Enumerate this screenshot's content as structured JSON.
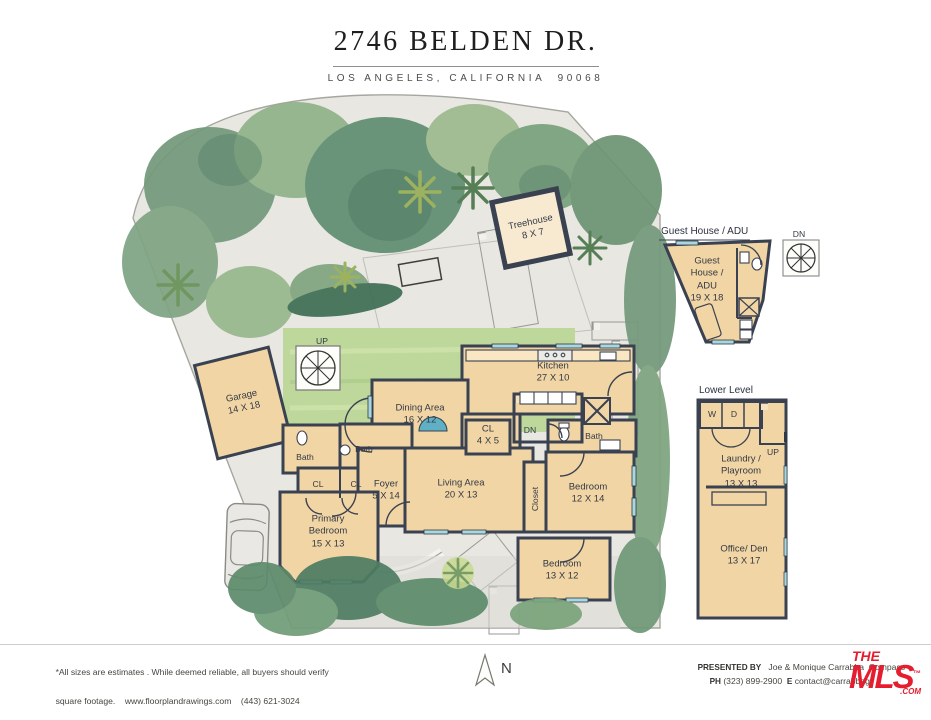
{
  "header": {
    "title": "2746 BELDEN DR.",
    "subtitle": "LOS ANGELES, CALIFORNIA  90068"
  },
  "site": {
    "treehouse": {
      "name": "Treehouse",
      "dims": "8 X 7"
    },
    "up_label": "UP"
  },
  "main_floor": {
    "garage": {
      "name": "Garage",
      "dims": "14 X 18"
    },
    "dining": {
      "name": "Dining Area",
      "dims": "16 X 12"
    },
    "kitchen": {
      "name": "Kitchen",
      "dims": "27 X 10"
    },
    "cl_small": {
      "name": "CL",
      "dims": "4 X 5"
    },
    "foyer": {
      "name": "Foyer",
      "dims": "5 X 14"
    },
    "living": {
      "name": "Living Area",
      "dims": "20 X 13"
    },
    "bedroom_right": {
      "name": "Bedroom",
      "dims": "12 X 14"
    },
    "primary": {
      "name": "Primary Bedroom",
      "dims": "15 X 13"
    },
    "bedroom_bottom": {
      "name": "Bedroom",
      "dims": "13 X 12"
    },
    "bath_left": "Bath",
    "bath_mid": "Bath",
    "bath_right": "Bath",
    "cl1": "CL",
    "cl2": "CL",
    "closet": "Closet",
    "dn": "DN"
  },
  "guest_house": {
    "heading": "Guest House / ADU",
    "dn": "DN",
    "name": "Guest House / ADU",
    "dims": "19 X 18"
  },
  "lower_level": {
    "heading": "Lower Level",
    "washer": "W",
    "dryer": "D",
    "up": "UP",
    "laundry": {
      "name": "Laundry / Playroom",
      "dims": "13 X 13"
    },
    "office": {
      "name": "Office/ Den",
      "dims": "13 X 17"
    }
  },
  "footer": {
    "disclaimer_line1": "*All sizes are estimates . While deemed reliable, all buyers should verify",
    "disclaimer_line2": "square footage.    www.floorplandrawings.com    (443) 621-3024",
    "north": "N",
    "presented_by_label": "PRESENTED BY",
    "presented_by": "   Joe & Monique Carrabba  Compass",
    "phone_label": "PH",
    "phone": " (323) 899-2900  ",
    "email_label": "E",
    "email": " contact@carrabbagr",
    "logo": {
      "the": "THE",
      "mls": "MLS",
      "com": ".COM",
      "tm": "™"
    }
  },
  "colors": {
    "room_fill": "#f2d5a4",
    "wall": "#3a4252",
    "window": "#a9d7de",
    "grass": "#bed89c",
    "water": "#5fb0c4",
    "logo_red": "#e41e2f"
  }
}
